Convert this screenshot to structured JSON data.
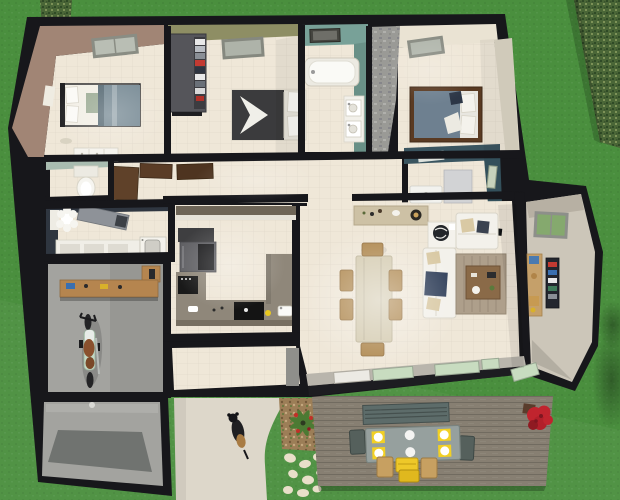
{
  "scene": {
    "type": "3d-floor-plan-render",
    "camera": "top-down-oblique",
    "house": {
      "rooms": [
        {
          "id": "bedroom-1",
          "features": [
            "skylight",
            "double-bed",
            "dresser",
            "wall-shelf"
          ]
        },
        {
          "id": "bedroom-2",
          "features": [
            "skylight",
            "open-wardrobe",
            "double-bed"
          ]
        },
        {
          "id": "bathroom",
          "features": [
            "window",
            "bathtub",
            "double-vanity"
          ]
        },
        {
          "id": "master-bedroom",
          "features": [
            "skylight",
            "stone-accent-wall",
            "double-bed"
          ]
        },
        {
          "id": "shower-room",
          "features": [
            "window",
            "shower-tray",
            "cabinet",
            "ceiling-vent"
          ]
        },
        {
          "id": "wc",
          "features": [
            "toilet"
          ]
        },
        {
          "id": "laundry-bathroom",
          "features": [
            "toilet",
            "counter",
            "cabinets",
            "washing-machine"
          ]
        },
        {
          "id": "garage-workshop",
          "features": [
            "workbench",
            "tools",
            "motorcycle"
          ]
        },
        {
          "id": "garage-bay",
          "features": [
            "concrete-floor",
            "floor-shadow"
          ]
        },
        {
          "id": "hallway",
          "features": [
            "open-doors"
          ]
        },
        {
          "id": "kitchen",
          "features": [
            "fridge",
            "oven",
            "cooktop",
            "sink",
            "u-shaped-counter"
          ]
        },
        {
          "id": "dining-area",
          "features": [
            "sideboard",
            "record-player",
            "dining-table",
            "six-chairs"
          ]
        },
        {
          "id": "living-area",
          "features": [
            "l-shaped-sofa",
            "coffee-table",
            "rug",
            "globe-on-cabinet",
            "wall-tv"
          ]
        },
        {
          "id": "entry-hall",
          "features": [
            "green-window",
            "bookshelf",
            "coat-rack"
          ]
        },
        {
          "id": "mudroom",
          "features": []
        }
      ],
      "south-wall": [
        "sliding-glass-doors"
      ]
    },
    "exterior": {
      "deck": [
        "bench",
        "outdoor-table",
        "yellow-placemats",
        "white-plates",
        "dark-chairs",
        "tan-chairs",
        "stacked-yellow-chairs",
        "potted-red-plant"
      ],
      "yard": [
        "lawn",
        "hedge-top-right",
        "tree-top-left",
        "stepping-stones",
        "gravel-bed-with-plant",
        "tree-shadows"
      ],
      "driveway": [
        "curved-path",
        "dog"
      ]
    }
  },
  "palette": {
    "grass": "#4a8f3e",
    "hedge": "#4a6637",
    "wall_black": "#17171b",
    "floor_tile": "#efe7d8",
    "wall_mauve": "#a18575",
    "wall_olive": "#8e8e64",
    "wall_teal": "#78a198",
    "wall_teal_dark": "#699087",
    "wall_cream": "#eae3d3",
    "wall_navy_teal": "#3a5560",
    "wall_sage": "#a9bcb0",
    "wall_slate": "#2f3640",
    "stone": "#9a9a96",
    "driveway": "#ddd7ca",
    "deck": "#877f72",
    "garage_floor": "#a3a39f",
    "garage_shadow": "#707370",
    "counter": "#8f877a",
    "wood_bench": "#b5854f",
    "wood_chair": "#b08a52",
    "table_wood": "#d5ccb2",
    "sideboard_wood": "#cdc1a5",
    "duvet_blue": "#7d8f99",
    "duvet_charcoal": "#3b3b3d",
    "duvet_slate": "#6e8090",
    "sofa_white": "#f3f1eb",
    "pillow_navy": "#31405a",
    "pillow_tan": "#d9c9a4",
    "rug": "#ae9f8b",
    "glass_green": "#c8dcc0",
    "window_green": "#85a96e",
    "placemat_yellow": "#f2d024",
    "chair_yellow": "#eec829",
    "flower_red": "#c0242e",
    "stone_path": "#e9dfc9",
    "gravel": "#9c7e57",
    "appliance_white": "#f2f0ea",
    "wardrobe": "#55555a",
    "door_brown": "#5a3c26"
  }
}
